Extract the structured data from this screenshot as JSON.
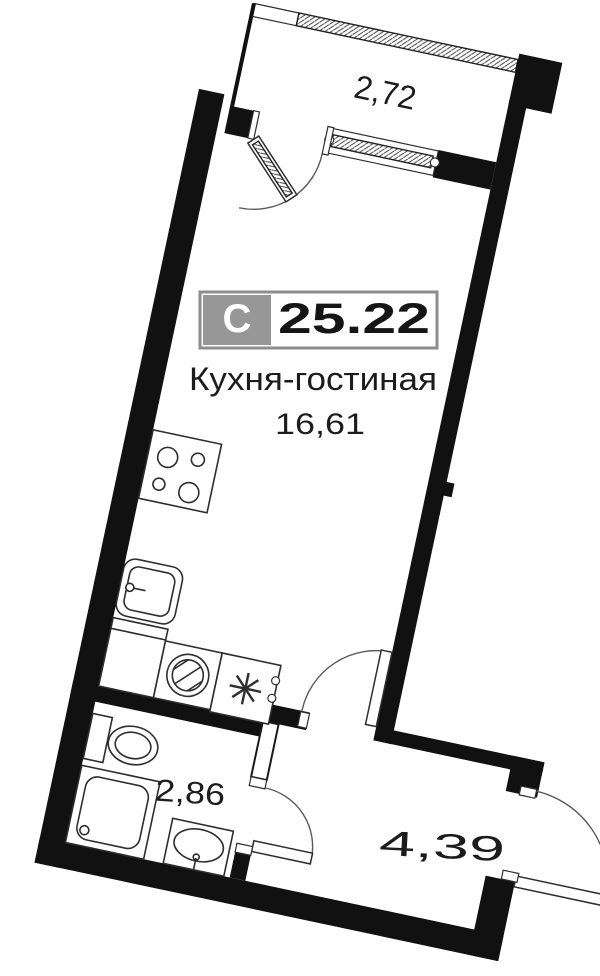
{
  "floor_plan": {
    "unit_badge": {
      "type_letter": "С",
      "total_area": "25.22"
    },
    "main_room": {
      "name": "Кухня-гостиная",
      "area": "16,61"
    },
    "balcony": {
      "dimension": "2,72"
    },
    "bathroom": {
      "area": "2,86"
    },
    "hallway": {
      "area": "4,39"
    },
    "colors": {
      "walls": "#111111",
      "fixture_line": "#2e2e2e",
      "badge_gray": "#979797",
      "badge_border": "#8d8d8d",
      "background": "#ffffff"
    }
  }
}
